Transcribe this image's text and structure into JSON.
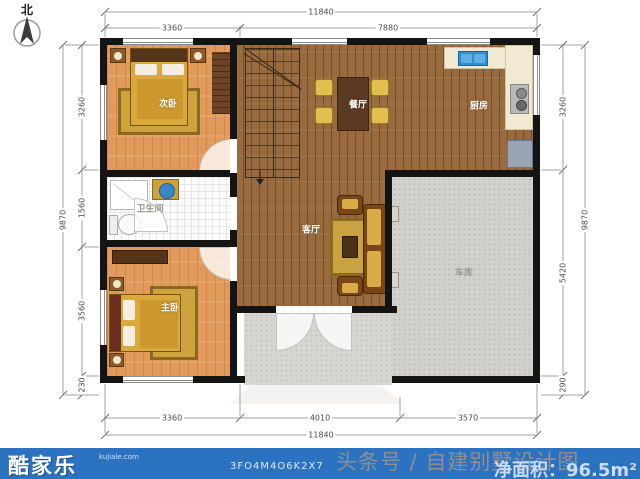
{
  "compass": {
    "label": "北"
  },
  "rooms": {
    "secondary_bedroom": "次卧",
    "bathroom": "卫生间",
    "master_bedroom": "主卧",
    "dining_room": "餐厅",
    "living_room": "客厅",
    "kitchen": "厨房",
    "garage": "车库"
  },
  "dims": {
    "top_total": "11840",
    "top_left": "3360",
    "top_right": "7880",
    "bottom_seg1": "3360",
    "bottom_seg2": "4010",
    "bottom_seg3": "3570",
    "bottom_total": "11840",
    "left_total": "9870",
    "left_seg1": "3260",
    "left_seg2": "1560",
    "left_seg3": "3560",
    "left_seg4": "230",
    "right_seg1": "3260",
    "right_seg2": "5420",
    "right_seg3": "290",
    "right_total": "9870"
  },
  "footer": {
    "logo": "酷家乐",
    "site": "kujiale.com",
    "plan_code": "3FO4M4O6K2X7",
    "watermark": "头条号 / 自建别墅设计图",
    "net_area": "净面积：96.5m²"
  },
  "colors": {
    "footer_bar": "#2b72c1",
    "wall": "#141414",
    "bedroom_floor": "#e2995c",
    "hall_floor": "#996a3d",
    "garage_floor": "#d3d1cd",
    "counter": "#f1e9d2",
    "sink_blue": "#2f8fd4",
    "accent_gold": "#d3a43a"
  }
}
